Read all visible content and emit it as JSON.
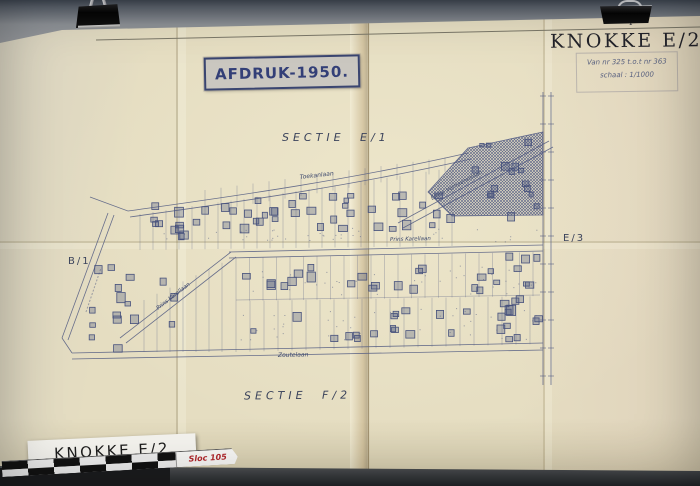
{
  "title_block": {
    "title": "KNOKKE E/2",
    "page_mark": "I",
    "range_text": "Van nr 325 t.o.t nr 363",
    "scale_text": "schaal : 1/1000"
  },
  "stamp": {
    "text": "AFDRUK-1950."
  },
  "map": {
    "section_labels": {
      "e1": "SECTIE E/1",
      "f2": "SECTIE F/2",
      "b1": "B/1",
      "e3": "E/3"
    },
    "street_labels": {
      "toekanlaan": "Toekanlaan",
      "emile_verhaerenlaan": "Emile Verhaerenlaan",
      "prins_karellaan": "Prins Karellaan",
      "prins_karellaan_diagonal": "Prins Karellaan",
      "zoutelaan": "Zoutelaan"
    }
  },
  "footer": {
    "map_label": "KNOKKE E/2",
    "ruler_tag": "Sloc 105"
  },
  "colors": {
    "paper": "#e5ddc1",
    "map_ink": "#5a6285",
    "building_ink": "#46517c",
    "stamp_ink": "#333f77",
    "title_ink": "#23232a",
    "board": "#909294",
    "ruler_tag_text": "#b0272c"
  }
}
